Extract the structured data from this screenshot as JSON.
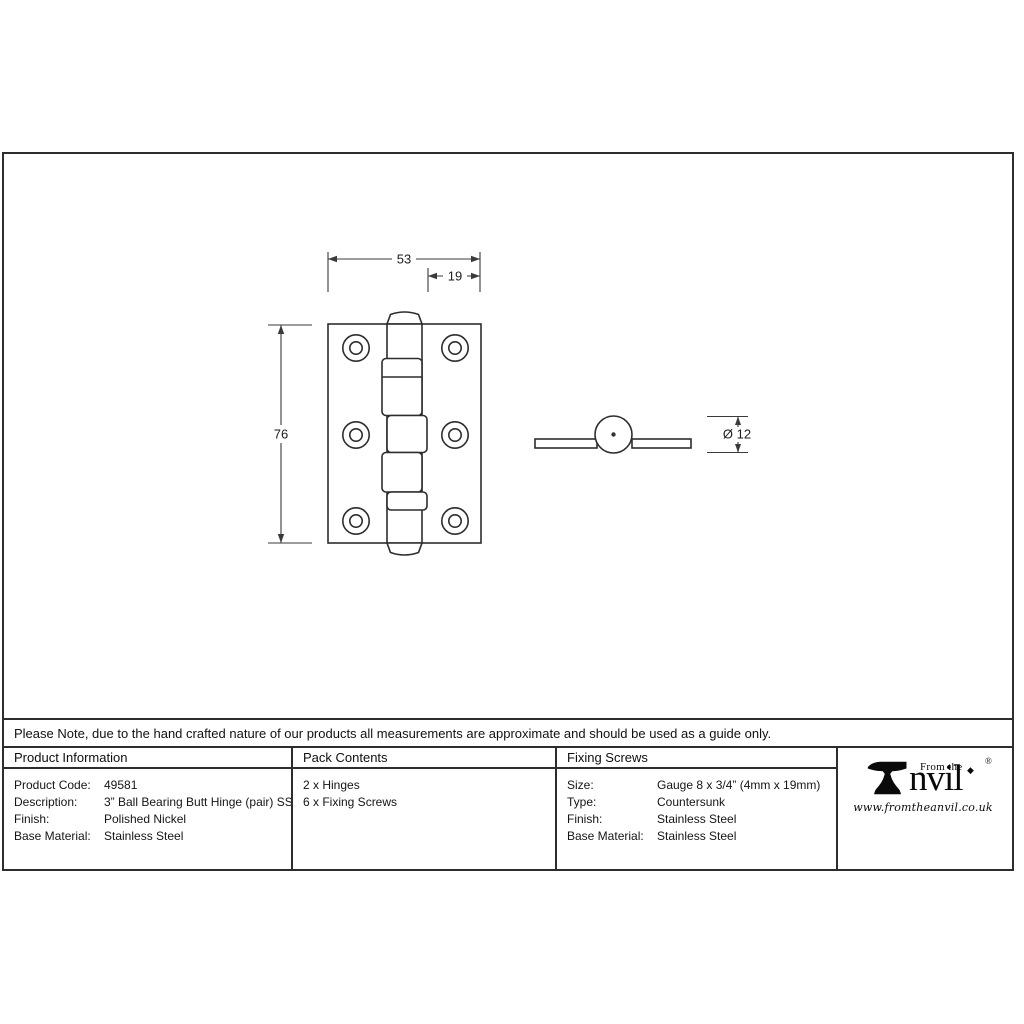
{
  "note": "Please Note, due to the hand crafted nature of our products all measurements are approximate and should be used as a guide only.",
  "drawing": {
    "dims": {
      "width": "53",
      "offset": "19",
      "height": "76",
      "diameter": "Ø 12"
    }
  },
  "table": {
    "product_info": {
      "header": "Product Information",
      "rows": [
        {
          "label": "Product Code:",
          "value": "49581"
        },
        {
          "label": "Description:",
          "value": "3” Ball Bearing Butt Hinge (pair) SS"
        },
        {
          "label": "Finish:",
          "value": "Polished Nickel"
        },
        {
          "label": "Base Material:",
          "value": "Stainless Steel"
        }
      ]
    },
    "pack_contents": {
      "header": "Pack Contents",
      "items": [
        "2 x Hinges",
        "6 x Fixing Screws"
      ]
    },
    "fixing_screws": {
      "header": "Fixing Screws",
      "rows": [
        {
          "label": "Size:",
          "value": "Gauge 8 x 3/4” (4mm x 19mm)"
        },
        {
          "label": "Type:",
          "value": "Countersunk"
        },
        {
          "label": "Finish:",
          "value": "Stainless Steel"
        },
        {
          "label": "Base Material:",
          "value": "Stainless Steel"
        }
      ]
    }
  },
  "brand": {
    "tagline": "From the",
    "star": "◆",
    "name_rest": "nvil",
    "registered": "®",
    "website": "www.fromtheanvil.co.uk"
  },
  "colors": {
    "object_line": "#2d2d2d",
    "dimension_line": "#3a3a3a",
    "background": "#ffffff"
  }
}
